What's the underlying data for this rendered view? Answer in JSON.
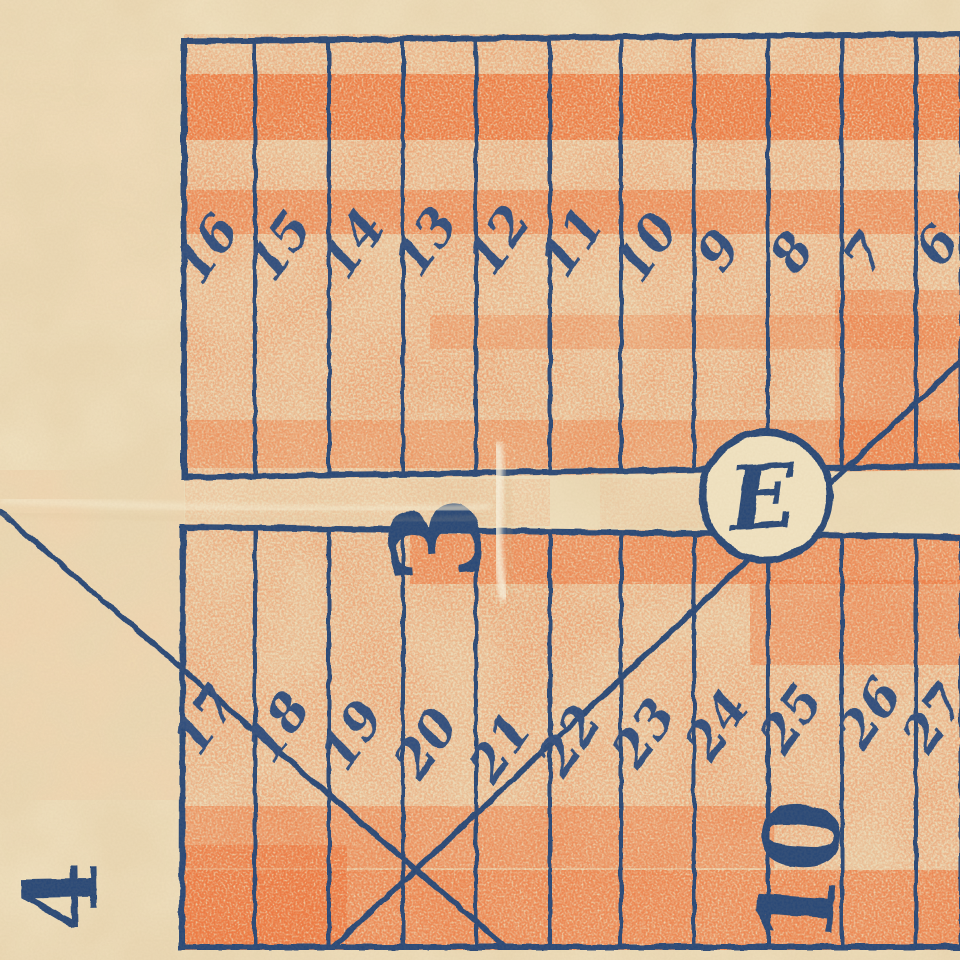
{
  "map": {
    "upper_block": {
      "lots": [
        "16",
        "15",
        "14",
        "13",
        "12",
        "11",
        "10",
        "9",
        "8",
        "7",
        "6"
      ]
    },
    "lower_block": {
      "lots": [
        "17",
        "18",
        "19",
        "20",
        "21",
        "22",
        "23",
        "24",
        "25",
        "26",
        "27"
      ]
    },
    "block_labels": {
      "center_street": "3",
      "lower_right": "10",
      "outside_left": "4"
    },
    "junction_circle_letter": "E",
    "colors": {
      "paper": "#ead7b3",
      "street_cream": "#f0e2c1",
      "crayon_orange": "#f09a6a",
      "crayon_orange_dense": "#ef7238",
      "ink_navy": "#2c4977",
      "ink_number": "#30507e"
    }
  }
}
